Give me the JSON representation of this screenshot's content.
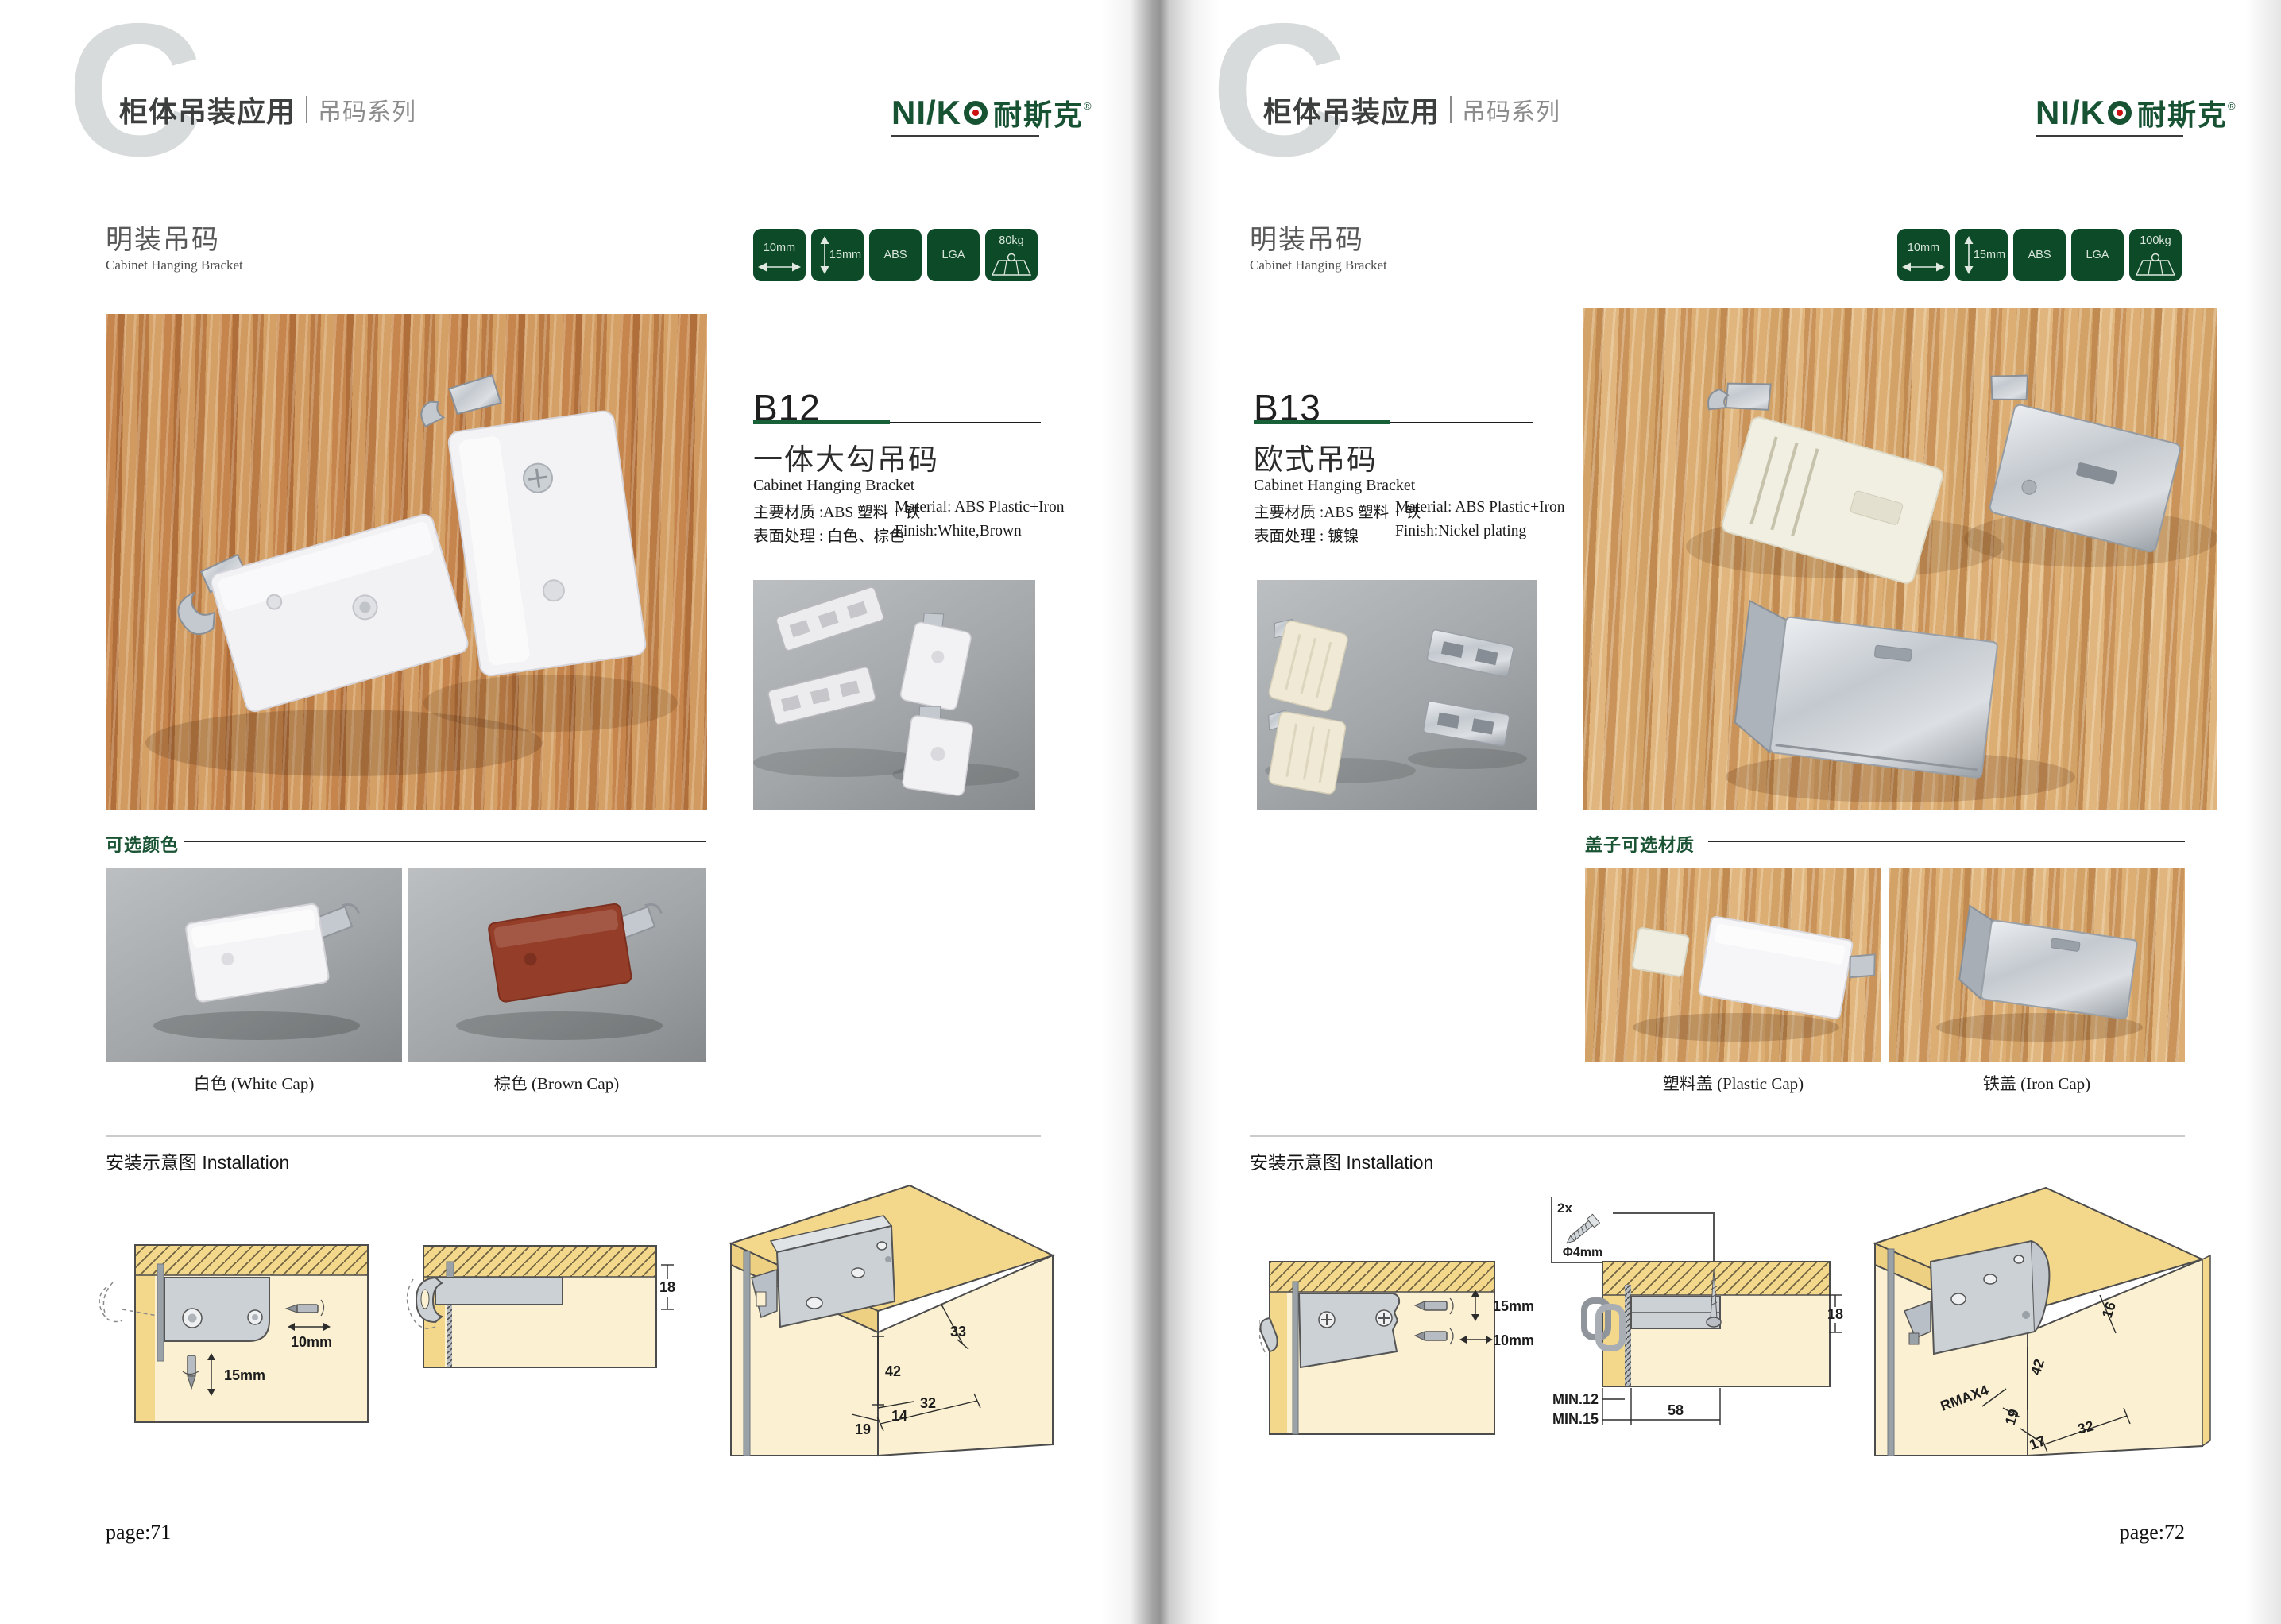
{
  "brand": {
    "logo_latin": "NI/K",
    "logo_cn": "耐斯克",
    "reg": "®",
    "green": "#175233",
    "badge_green": "#0d4a27"
  },
  "left": {
    "watermark": "C",
    "header": {
      "title": "柜体吊装应用",
      "series": "吊码系列"
    },
    "section": {
      "title_zh": "明装吊码",
      "title_en": "Cabinet Hanging Bracket"
    },
    "badges": {
      "width": "10mm",
      "height": "15mm",
      "material": "ABS",
      "cert": "LGA",
      "load": "80kg"
    },
    "product": {
      "code": "B12",
      "name_zh": "一体大勾吊码",
      "name_en": "Cabinet Hanging Bracket",
      "material_zh": "主要材质 :ABS 塑料 + 铁",
      "material_en": "Material: ABS Plastic+Iron",
      "finish_zh": "表面处理 : 白色、棕色",
      "finish_en": "Finish:White,Brown"
    },
    "options": {
      "label": "可选颜色",
      "caption_1": "白色 (White Cap)",
      "caption_2": "棕色 (Brown Cap)"
    },
    "install": {
      "label": "安装示意图 Installation",
      "d1_horiz": "10mm",
      "d1_vert": "15mm",
      "d2_thickness": "18",
      "d3_a": "33",
      "d3_b": "42",
      "d3_c": "32",
      "d3_d": "14",
      "d3_e": "19"
    },
    "page_no": "page:71"
  },
  "right": {
    "watermark": "C",
    "header": {
      "title": "柜体吊装应用",
      "series": "吊码系列"
    },
    "section": {
      "title_zh": "明装吊码",
      "title_en": "Cabinet Hanging Bracket"
    },
    "badges": {
      "width": "10mm",
      "height": "15mm",
      "material": "ABS",
      "cert": "LGA",
      "load": "100kg"
    },
    "product": {
      "code": "B13",
      "name_zh": "欧式吊码",
      "name_en": "Cabinet Hanging Bracket",
      "material_zh": "主要材质 :ABS 塑料 + 铁",
      "material_en": "Material: ABS Plastic+Iron",
      "finish_zh": "表面处理 : 镀镍",
      "finish_en": "Finish:Nickel plating"
    },
    "options": {
      "label": "盖子可选材质",
      "caption_1": "塑料盖 (Plastic Cap)",
      "caption_2": "铁盖 (Iron Cap)"
    },
    "install": {
      "label": "安装示意图 Installation",
      "screw_qty": "2x",
      "screw_dia": "Φ4mm",
      "d1_vert": "15mm",
      "d1_horiz": "10mm",
      "d2_min1": "MIN.12",
      "d2_min2": "MIN.15",
      "d2_width": "58",
      "d2_thickness": "18",
      "d3_a": "16",
      "d3_b": "42",
      "d3_rmax": "RMAX4",
      "d3_c": "19",
      "d3_d": "17",
      "d3_e": "32"
    },
    "page_no": "page:72"
  }
}
